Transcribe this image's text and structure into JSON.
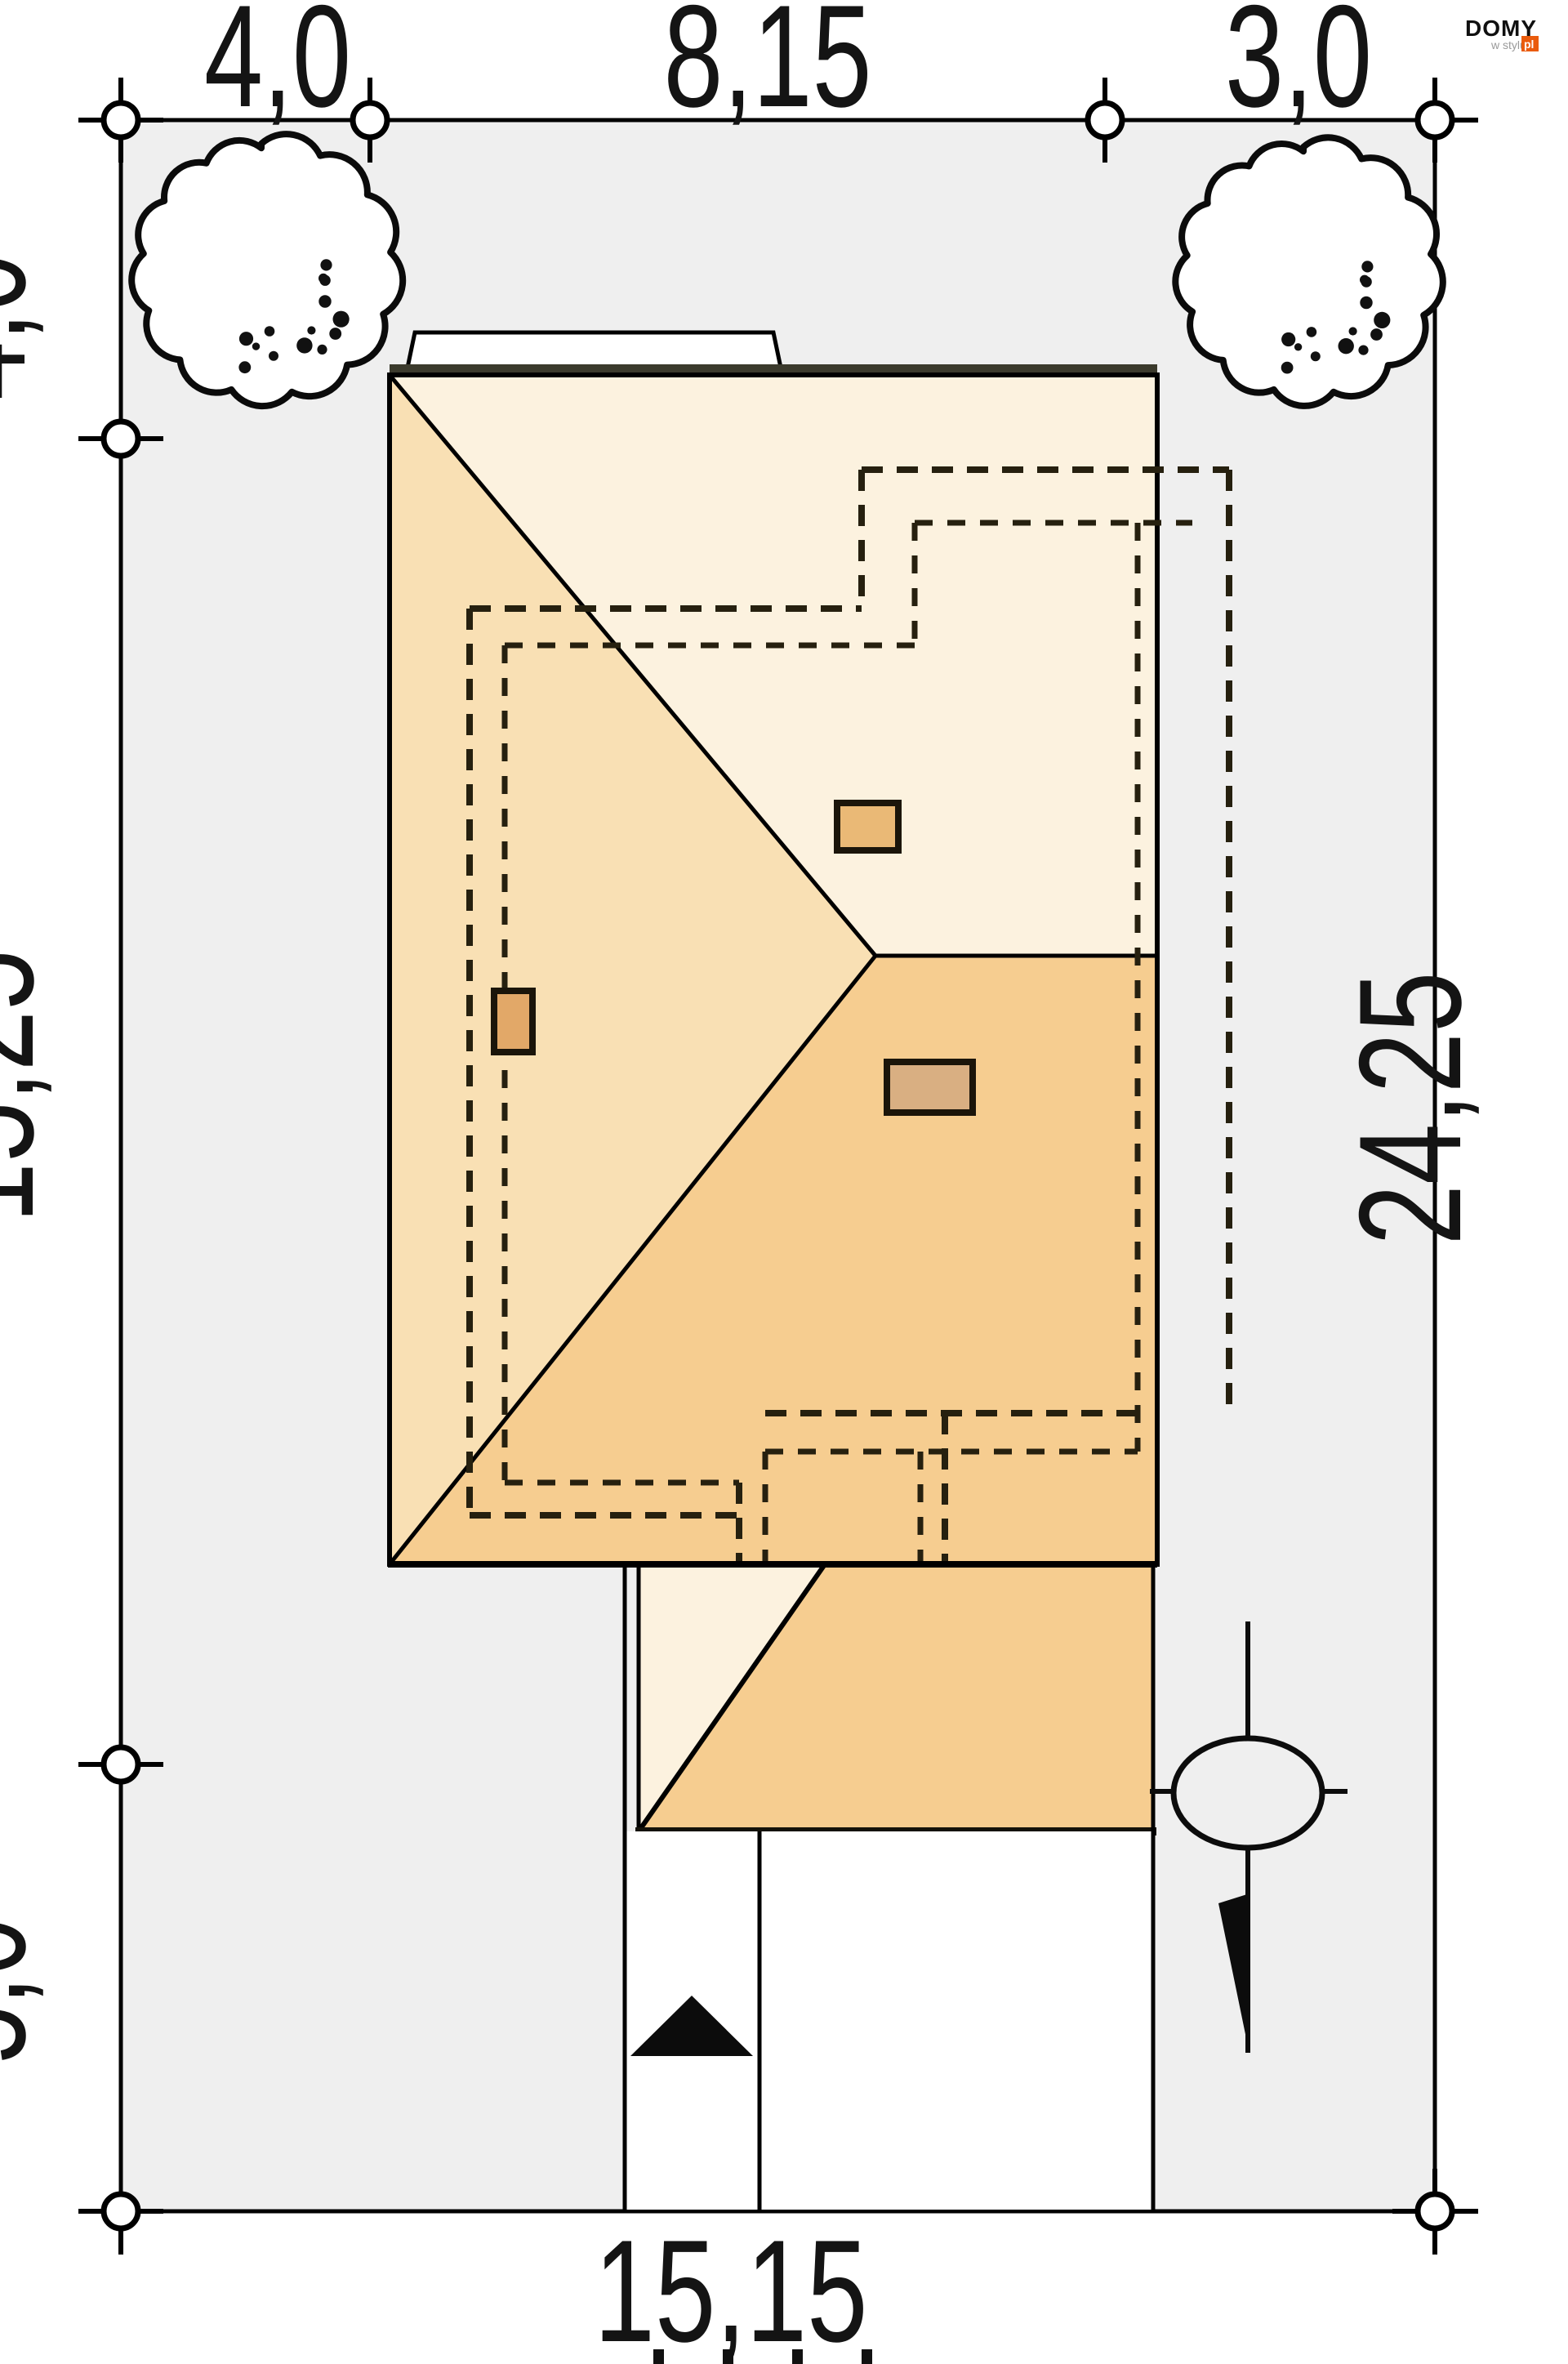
{
  "dimensions": {
    "top": [
      {
        "value": "4,0"
      },
      {
        "value": "8,15"
      },
      {
        "value": "3,0"
      }
    ],
    "left": [
      {
        "value": "4,0"
      },
      {
        "value": "15,25"
      },
      {
        "value": "5,0"
      }
    ],
    "right": [
      {
        "value": "24,25"
      }
    ],
    "bottom": [
      {
        "value": "15,15"
      }
    ]
  },
  "logo": {
    "name": "DOMY",
    "tagline": "w stylu",
    "domain_suffix": "pl"
  },
  "palette": {
    "plot_fill": "#efefef",
    "roof_north_slope": "#fcf2df",
    "roof_west_slope": "#f9e0b4",
    "roof_south_slope": "#f6cd90",
    "chimney_fill": "#e5b176",
    "eave_band": "#3b3a2c",
    "logo_orange": "#ea5b0c",
    "line_color": "#000000"
  },
  "symbols": {
    "trees": 2,
    "north_arrow": "black triangle",
    "utility": "circle with lightning bolt"
  }
}
